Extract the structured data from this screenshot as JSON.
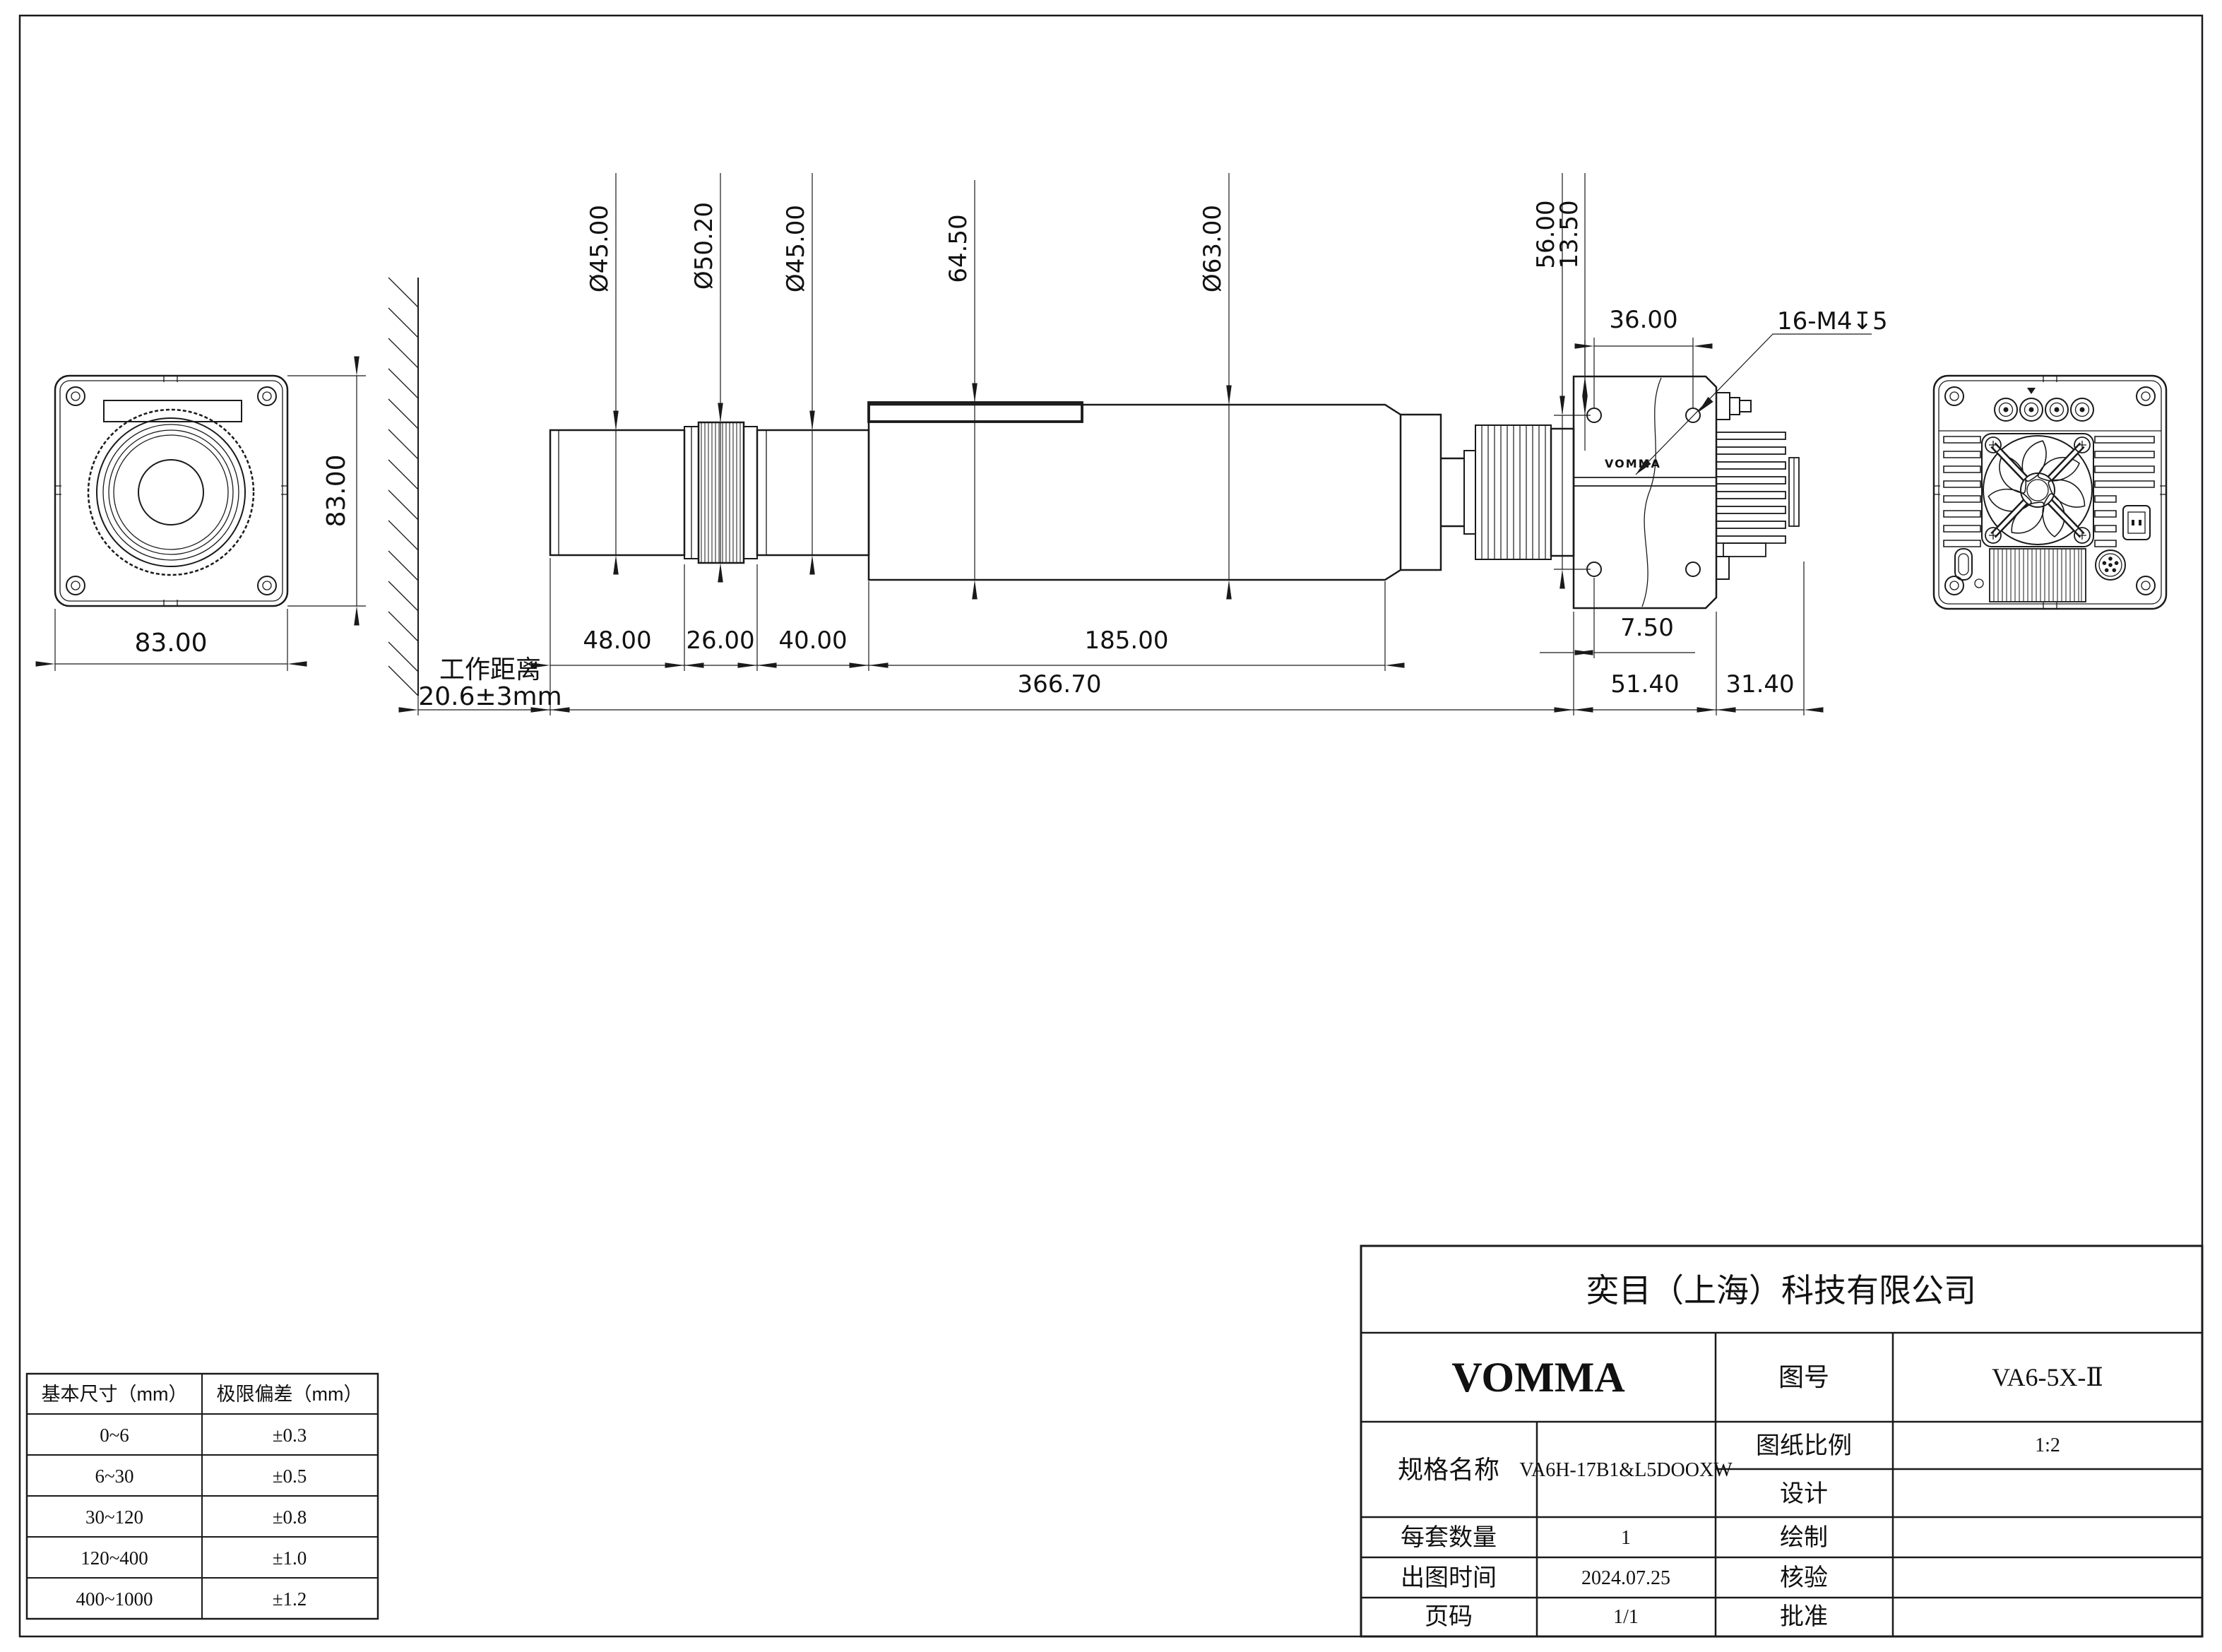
{
  "front_view": {
    "width_dim": "83.00",
    "height_dim": "83.00"
  },
  "side_view": {
    "working_distance_label": "工作距离",
    "working_distance_value": "20.6±3mm",
    "dia_front": "Ø45.00",
    "dia_knurl": "Ø50.20",
    "dia_mid": "Ø45.00",
    "collar_height": "64.50",
    "dia_main": "Ø63.00",
    "len_48": "48.00",
    "len_26": "26.00",
    "len_40": "40.00",
    "len_185": "185.00",
    "len_total": "366.70",
    "len_body": "51.40",
    "len_heatsink": "31.40",
    "len_7_5": "7.50",
    "hole_span_v": "56.00",
    "hole_offset_v": "13.50",
    "hole_span_h": "36.00",
    "thread_note": "16-M4↧5",
    "body_logo": "VOMMA"
  },
  "tolerance_table": {
    "headers": [
      "基本尺寸（mm）",
      "极限偏差（mm）"
    ],
    "rows": [
      [
        "0~6",
        "±0.3"
      ],
      [
        "6~30",
        "±0.5"
      ],
      [
        "30~120",
        "±0.8"
      ],
      [
        "120~400",
        "±1.0"
      ],
      [
        "400~1000",
        "±1.2"
      ]
    ]
  },
  "title_block": {
    "company": "奕目（上海）科技有限公司",
    "brand": "VOMMA",
    "drawing_no_label": "图号",
    "drawing_no": "VA6-5X-Ⅱ",
    "spec_label": "规格名称",
    "spec": "VA6H-17B1&L5DOOXW",
    "scale_label": "图纸比例",
    "scale": "1:2",
    "design_label": "设计",
    "qty_label": "每套数量",
    "qty": "1",
    "draft_label": "绘制",
    "date_label": "出图时间",
    "date": "2024.07.25",
    "check_label": "核验",
    "page_label": "页码",
    "page": "1/1",
    "approve_label": "批准"
  }
}
